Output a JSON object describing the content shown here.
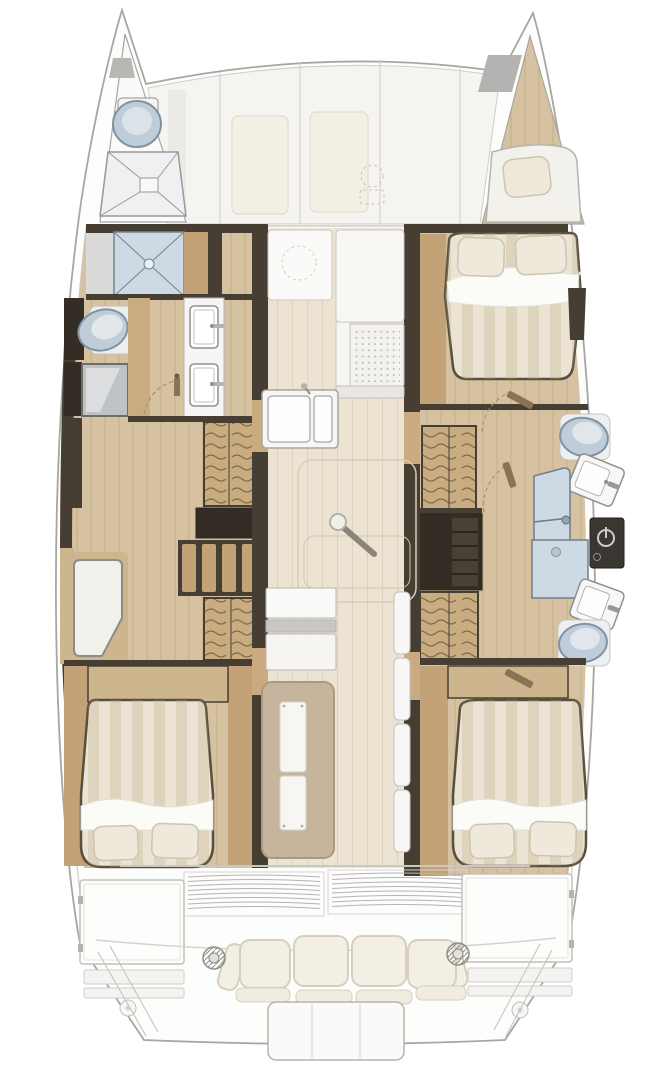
{
  "meta": {
    "title": "Catamaran yacht interior layout — top-down floor plan",
    "view": "top-down",
    "visible_text": []
  },
  "colors": {
    "outline": "#a8a6a3",
    "hullFill": "#fdfdfc",
    "deckFill": "#f6f4f0",
    "deckLine": "#cfcdc9",
    "panelCream": "#f3efe5",
    "wallDark": "#473e33",
    "wallDarker": "#332d25",
    "woodFloor": "#d6c2a0",
    "woodMid": "#c2a276",
    "woodStep": "#c9ad80",
    "woodTrim": "#cdb58e",
    "saloonFloor": "#ede3d3",
    "bedBase": "#ebe4d4",
    "sheetWhite": "#fbfbf8",
    "pillow": "#efe9db",
    "pillowEdge": "#cdc5b0",
    "fixtureWhite": "#f6f5f3",
    "fixtureLine": "#918f8b",
    "toiletBlue": "#bfcdda",
    "toiletRim": "#7f93a2",
    "showerBlue": "#cdd9e3",
    "showerLine": "#73828e",
    "metal": "#bfc2c4",
    "panelBlack": "#3a3733",
    "cushionCream": "#f4efe4",
    "cushionLine": "#d6cfbd",
    "tableTan": "#c6b59c",
    "benchWhite": "#f8f7f5",
    "doorWood": "#8a7354",
    "doorArc": "#a09279"
  },
  "vessel": {
    "type": "sailing-catamaran",
    "foredeck": {
      "features": [
        "deck-panels",
        "deck-hatches",
        "windlass"
      ]
    },
    "port_bow": {
      "name": "port-forepeak-head",
      "features": [
        "marine-toilet",
        "shower-pan"
      ]
    },
    "starboard_bow": {
      "name": "starboard-forepeak-berth",
      "features": [
        "berth-cushion",
        "pillow"
      ]
    },
    "port_hull": {
      "compartments": [
        "shower-room",
        "head-with-twin-vanity-sinks",
        "companionway-steps",
        "drawer-chest",
        "dressing-seat",
        "aft-double-cabin"
      ]
    },
    "starboard_hull": {
      "compartments": [
        "forward-double-cabin",
        "forward-head-with-toilet-and-sink",
        "shower-door",
        "electrical-panel",
        "aft-head-with-shower-sink-toilet",
        "companionway-steps",
        "wardrobe",
        "aft-double-cabin"
      ]
    },
    "saloon": {
      "features": [
        "forward-settee",
        "stove",
        "galley-double-sink",
        "floor-hatch",
        "saloon-table",
        "bench-seats",
        "fridge-cabinets"
      ]
    },
    "cockpit": {
      "features": [
        "sliding-door-louvers",
        "storage-lockers",
        "bench-seating",
        "winches",
        "swim-platform",
        "transom-steps"
      ]
    }
  }
}
